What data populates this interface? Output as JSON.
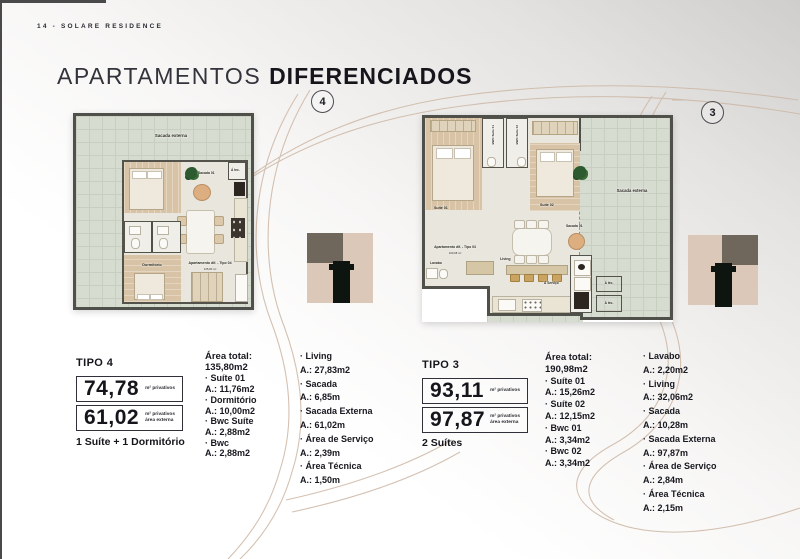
{
  "page": {
    "kicker": "14 - SOLARE RESIDENCE",
    "title_light": "APARTAMENTOS",
    "title_bold": "DIFERENCIADOS"
  },
  "colors": {
    "accent_curve": "#cdb7a5",
    "wall": "#50504a",
    "logo_beige": "#dcc8b8",
    "logo_olive": "#6f675c",
    "logo_black": "#0e140f"
  },
  "plan4_drawing": {
    "badge": "4",
    "sacada_externa": "Sacada externa",
    "sacada_01": "Sacada 01",
    "area_tecnica": "Á tec.",
    "dormitorio": "Dormitório",
    "unit_title": "Apartamento dif. - Tipo 04",
    "unit_area": "135,80 m²"
  },
  "plan3_drawing": {
    "badge": "3",
    "suite_01": "Suíte 01",
    "bwc_suite_01": "BWC Suíte 01",
    "bwc_suite_02": "BWC Suíte 02",
    "suite_02": "Suíte 02",
    "sacada_externa": "Sacada externa",
    "sacada_01": "Sacada 01",
    "living": "Living",
    "lavabo": "Lavabo",
    "unit_title": "Apartamento dif. - Tipo 03",
    "unit_area": "190,98 m²",
    "servico": "Á Serviço",
    "tecnica_1": "Á téc.",
    "tecnica_2": "Á téc."
  },
  "tipo4": {
    "title": "TIPO 4",
    "private_area": "74,78",
    "private_area_unit": "m² privativos",
    "external_area": "61,02",
    "external_area_unit_line1": "m² privativos",
    "external_area_unit_line2": "área externa",
    "summary": "1 Suíte + 1 Dormitório",
    "total_label": "Área total:",
    "total_value": "135,80m2",
    "areas_col1": [
      {
        "name": "Suíte 01",
        "value": "A.: 11,76m2"
      },
      {
        "name": "Dormitório",
        "value": "A.: 10,00m2"
      },
      {
        "name": "Bwc Suíte",
        "value": "A.: 2,88m2"
      },
      {
        "name": "Bwc",
        "value": "A.: 2,88m2"
      }
    ],
    "areas_col2": [
      {
        "name": "Living",
        "value": "A.: 27,83m2"
      },
      {
        "name": "Sacada",
        "value": "A.: 6,85m"
      },
      {
        "name": "Sacada Externa",
        "value": "A.: 61,02m"
      },
      {
        "name": "Área de Serviço",
        "value": "A.: 2,39m"
      },
      {
        "name": "Área Técnica",
        "value": "A.: 1,50m"
      }
    ]
  },
  "tipo3": {
    "title": "TIPO 3",
    "private_area": "93,11",
    "private_area_unit": "m² privativos",
    "external_area": "97,87",
    "external_area_unit_line1": "m² privativos",
    "external_area_unit_line2": "área externa",
    "summary": "2 Suítes",
    "total_label": "Área total:",
    "total_value": "190,98m2",
    "areas_col1": [
      {
        "name": "Suíte 01",
        "value": "A.: 15,26m2"
      },
      {
        "name": "Suíte 02",
        "value": "A.: 12,15m2"
      },
      {
        "name": "Bwc 01",
        "value": "A.: 3,34m2"
      },
      {
        "name": "Bwc 02",
        "value": "A.: 3,34m2"
      }
    ],
    "areas_col2": [
      {
        "name": "Lavabo",
        "value": "A.: 2,20m2"
      },
      {
        "name": "Living",
        "value": "A.: 32,06m2"
      },
      {
        "name": "Sacada",
        "value": "A.: 10,28m"
      },
      {
        "name": "Sacada Externa",
        "value": "A.: 97,87m"
      },
      {
        "name": "Área de Serviço",
        "value": "A.: 2,84m"
      },
      {
        "name": "Área Técnica",
        "value": "A.: 2,15m"
      }
    ]
  }
}
